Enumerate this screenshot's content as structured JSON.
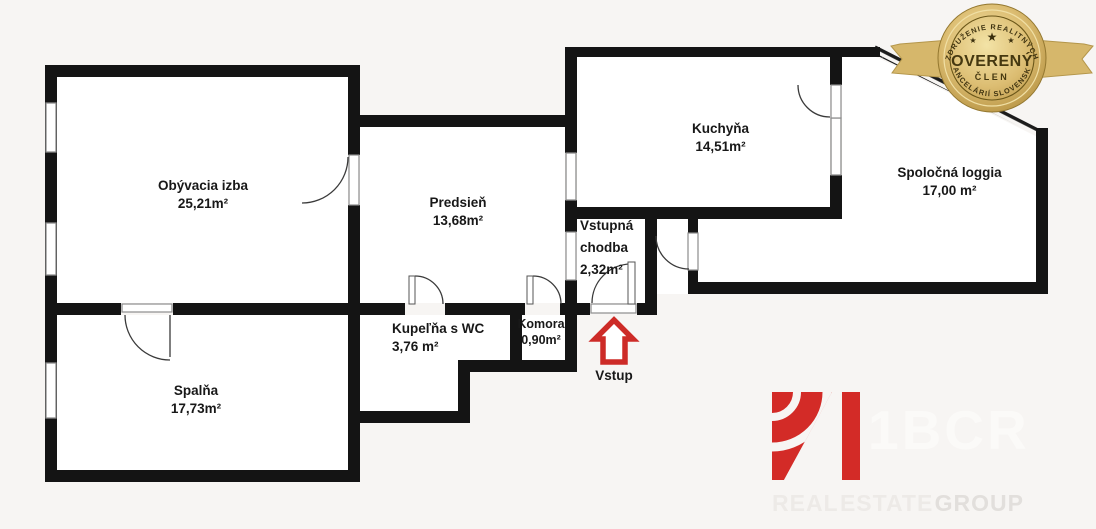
{
  "floorplan": {
    "rooms": {
      "obyvacia": {
        "name": "Obývacia izba",
        "area": "25,21m²"
      },
      "spalna": {
        "name": "Spalňa",
        "area": "17,73m²"
      },
      "predsien": {
        "name": "Predsieň",
        "area": "13,68m²"
      },
      "kuchyna": {
        "name": "Kuchyňa",
        "area": "14,51m²"
      },
      "loggia": {
        "name": "Spoločná loggia",
        "area": "17,00 m²"
      },
      "chodba": {
        "name_line1": "Vstupná",
        "name_line2": "chodba",
        "area": "2,32m²"
      },
      "kupelna": {
        "name": "Kupeľňa s WC",
        "area": "3,76 m²"
      },
      "komora": {
        "name": "Komora",
        "area": "0,90m²"
      }
    },
    "entrance": {
      "label": "Vstup"
    },
    "colors": {
      "wall": "#141414",
      "entrance_arrow": "#cd2b27",
      "background": "#f7f5f3"
    }
  },
  "badge": {
    "arc_top": "ZDRUŽENIE REALITNÝCH",
    "title": "OVERENÝ",
    "subtitle": "ČLEN",
    "arc_bottom": "KANCELÁRIÍ SLOVENSKA",
    "star": "★",
    "gold": "#d9ba6e"
  },
  "logo": {
    "brand": "1BCR",
    "word1": "REAL",
    "word2": "ESTATE",
    "word3": "GROUP",
    "red": "#d32b27"
  }
}
